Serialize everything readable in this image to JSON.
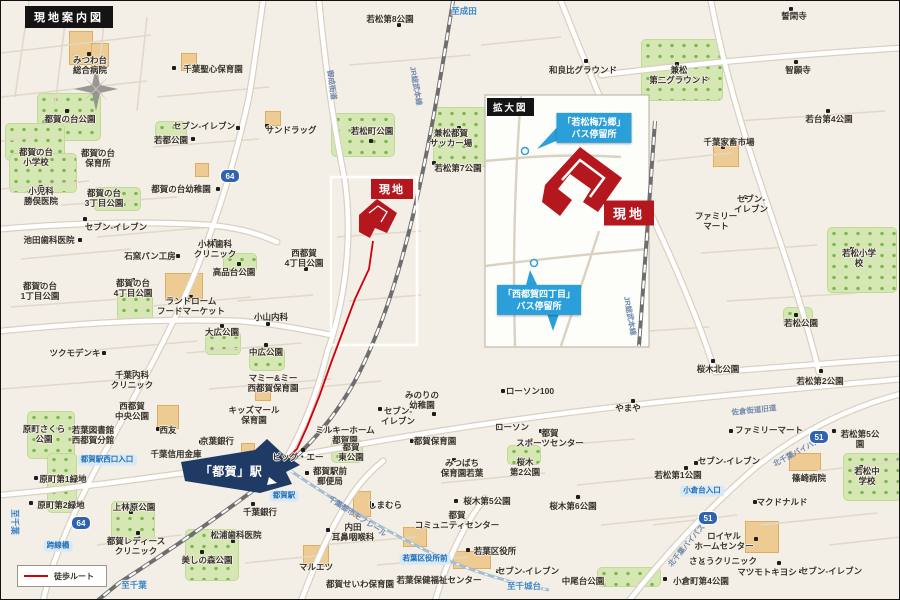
{
  "map": {
    "title_badge": "現地案内図",
    "inset_badge": "拡大図",
    "site_label_main": "現地",
    "site_label_inset": "現地",
    "station_label": "「都賀」駅",
    "legend_walk_route": "徒歩ルート",
    "colors": {
      "background": "#f3efe6",
      "site_red": "#b5171e",
      "route_red": "#cf000e",
      "callout_blue": "#2b9fd9",
      "station_navy": "#203a66",
      "park_green": "#d5e7b2",
      "building_tan": "#eecb92",
      "road_white": "#ffffff"
    },
    "callouts": [
      {
        "lines": [
          "「若松梅乃郷」",
          "バス停留所"
        ],
        "x": 593,
        "y": 127
      },
      {
        "lines": [
          "「西都賀四丁目」",
          "バス停留所"
        ],
        "x": 538,
        "y": 299
      }
    ],
    "shields": [
      {
        "n": "64",
        "x": 229,
        "y": 175
      },
      {
        "n": "64",
        "x": 80,
        "y": 522
      },
      {
        "n": "51",
        "x": 818,
        "y": 436
      },
      {
        "n": "51",
        "x": 707,
        "y": 517
      }
    ],
    "labels": [
      {
        "t": "みつわ台\n総合病院",
        "x": 89,
        "y": 64
      },
      {
        "t": "千葉聖心保育園",
        "x": 212,
        "y": 68
      },
      {
        "t": "都賀の台公園",
        "x": 69,
        "y": 118
      },
      {
        "t": "セブン-イレブン",
        "x": 203,
        "y": 125
      },
      {
        "t": "サンドラッグ",
        "x": 290,
        "y": 129
      },
      {
        "t": "若都公園",
        "x": 170,
        "y": 139
      },
      {
        "t": "都賀の台\n小学校",
        "x": 35,
        "y": 156
      },
      {
        "t": "都賀の台\n保育所",
        "x": 97,
        "y": 157
      },
      {
        "t": "小児科\n勝俣医院",
        "x": 40,
        "y": 195
      },
      {
        "t": "都賀の台幼稚園",
        "x": 180,
        "y": 188
      },
      {
        "t": "都賀の台\n3丁目公園",
        "x": 103,
        "y": 197
      },
      {
        "t": "セブン-イレブン",
        "x": 115,
        "y": 226
      },
      {
        "t": "池田歯科医院",
        "x": 48,
        "y": 239
      },
      {
        "t": "石窯パン工房",
        "x": 149,
        "y": 255
      },
      {
        "t": "小林歯科\nクリニック",
        "x": 214,
        "y": 248
      },
      {
        "t": "高品台公園",
        "x": 233,
        "y": 271
      },
      {
        "t": "都賀の台\n1丁目公園",
        "x": 39,
        "y": 290
      },
      {
        "t": "都賀の台\n4丁目公園",
        "x": 132,
        "y": 287
      },
      {
        "t": "ランドローム\nフードマーケット",
        "x": 190,
        "y": 305
      },
      {
        "t": "小山内科",
        "x": 270,
        "y": 316
      },
      {
        "t": "大広公園",
        "x": 221,
        "y": 331
      },
      {
        "t": "中広公園",
        "x": 265,
        "y": 351
      },
      {
        "t": "ツクモデンキ",
        "x": 74,
        "y": 352
      },
      {
        "t": "千葉内科\nクリニック",
        "x": 131,
        "y": 379
      },
      {
        "t": "西都賀\n4丁目公園",
        "x": 303,
        "y": 257
      },
      {
        "t": "若松第8公園",
        "x": 389,
        "y": 18
      },
      {
        "t": "若松町公園",
        "x": 371,
        "y": 130
      },
      {
        "t": "兼松都賀\nサッカー場",
        "x": 450,
        "y": 137
      },
      {
        "t": "若松第7公園",
        "x": 457,
        "y": 167
      },
      {
        "t": "和良比グラウンド",
        "x": 582,
        "y": 69
      },
      {
        "t": "兼松\n第二グラウンド",
        "x": 678,
        "y": 74
      },
      {
        "t": "智願寺",
        "x": 797,
        "y": 69
      },
      {
        "t": "誓閑寺",
        "x": 793,
        "y": 15
      },
      {
        "t": "若台第4公園",
        "x": 828,
        "y": 118
      },
      {
        "t": "千葉家畜市場",
        "x": 728,
        "y": 141
      },
      {
        "t": "セブン-\nイレブン",
        "x": 750,
        "y": 203
      },
      {
        "t": "ファミリー\nマート",
        "x": 715,
        "y": 220
      },
      {
        "t": "若松小学校",
        "x": 858,
        "y": 257
      },
      {
        "t": "若松公園",
        "x": 800,
        "y": 322
      },
      {
        "t": "若松第2公園",
        "x": 819,
        "y": 380
      },
      {
        "t": "桜木北公園",
        "x": 717,
        "y": 368
      },
      {
        "t": "やまや",
        "x": 627,
        "y": 407
      },
      {
        "t": "ローソン100",
        "x": 529,
        "y": 390
      },
      {
        "t": "ファミリーマート",
        "x": 768,
        "y": 429
      },
      {
        "t": "若松第5公園",
        "x": 859,
        "y": 438
      },
      {
        "t": "セブン-イレブン",
        "x": 728,
        "y": 460
      },
      {
        "t": "若松第1公園",
        "x": 677,
        "y": 474
      },
      {
        "t": "マクドナルド",
        "x": 781,
        "y": 501
      },
      {
        "t": "篠崎病院",
        "x": 808,
        "y": 477
      },
      {
        "t": "若松中学校",
        "x": 866,
        "y": 475
      },
      {
        "t": "ロイヤル\nホームセンター",
        "x": 723,
        "y": 540
      },
      {
        "t": "さとうクリニック",
        "x": 722,
        "y": 560
      },
      {
        "t": "マツモトキヨシ",
        "x": 766,
        "y": 571
      },
      {
        "t": "セブン-イレブン",
        "x": 830,
        "y": 570
      },
      {
        "t": "小倉町第4公園",
        "x": 700,
        "y": 580
      },
      {
        "t": "中尾台公園",
        "x": 582,
        "y": 580
      },
      {
        "t": "みのりの\n幼稚園",
        "x": 421,
        "y": 399
      },
      {
        "t": "セブン-\nイレブン",
        "x": 397,
        "y": 415
      },
      {
        "t": "ローソン",
        "x": 511,
        "y": 426
      },
      {
        "t": "都賀\nスポーツセンター",
        "x": 549,
        "y": 437
      },
      {
        "t": "都賀保育園",
        "x": 434,
        "y": 440
      },
      {
        "t": "ミルキーホーム\n都賀園",
        "x": 344,
        "y": 434
      },
      {
        "t": "都賀\n東公園",
        "x": 350,
        "y": 451
      },
      {
        "t": "みつばち\n保育園若葉",
        "x": 461,
        "y": 467
      },
      {
        "t": "桜木\n第2公園",
        "x": 524,
        "y": 466
      },
      {
        "t": "桜木第5公園",
        "x": 486,
        "y": 500
      },
      {
        "t": "桜木第6公園",
        "x": 572,
        "y": 505
      },
      {
        "t": "都賀\nコミュニティセンター",
        "x": 456,
        "y": 519
      },
      {
        "t": "若葉区役所",
        "x": 494,
        "y": 550
      },
      {
        "t": "若葉保健福祉センター",
        "x": 438,
        "y": 579
      },
      {
        "t": "セブン-イレブン",
        "x": 527,
        "y": 570
      },
      {
        "t": "マルエツ",
        "x": 315,
        "y": 566
      },
      {
        "t": "都賀せいわ保育園",
        "x": 359,
        "y": 583
      },
      {
        "t": "内田\n耳鼻咽喉科",
        "x": 352,
        "y": 531
      },
      {
        "t": "しまむら",
        "x": 384,
        "y": 504
      },
      {
        "t": "都賀駅前\n郵便局",
        "x": 329,
        "y": 475
      },
      {
        "t": "ビッグ・エー",
        "x": 297,
        "y": 456
      },
      {
        "t": "千葉銀行",
        "x": 259,
        "y": 511
      },
      {
        "t": "松浦歯科医院",
        "x": 235,
        "y": 534
      },
      {
        "t": "美しの森公園",
        "x": 206,
        "y": 559
      },
      {
        "t": "都賀レディース\nクリニック",
        "x": 135,
        "y": 545
      },
      {
        "t": "上林原公園",
        "x": 133,
        "y": 506
      },
      {
        "t": "原町第1緑地",
        "x": 62,
        "y": 478
      },
      {
        "t": "原町第2緑地",
        "x": 60,
        "y": 504
      },
      {
        "t": "原町さくら\n公園",
        "x": 43,
        "y": 433
      },
      {
        "t": "若葉図書館\n西都賀分館",
        "x": 92,
        "y": 434
      },
      {
        "t": "西都賀\n中央公園",
        "x": 131,
        "y": 410
      },
      {
        "t": "西友",
        "x": 167,
        "y": 429
      },
      {
        "t": "京葉銀行",
        "x": 216,
        "y": 440
      },
      {
        "t": "千葉信用金庫",
        "x": 175,
        "y": 453
      },
      {
        "t": "キッズマール\n保育園",
        "x": 253,
        "y": 414
      },
      {
        "t": "マミー&ミー\n西都賀保育園",
        "x": 272,
        "y": 382
      },
      {
        "t": "至成田",
        "x": 463,
        "y": 10,
        "c": "blue"
      },
      {
        "t": "至千葉",
        "x": 133,
        "y": 584,
        "c": "blue"
      },
      {
        "t": "至千城台",
        "x": 523,
        "y": 585,
        "c": "blue"
      },
      {
        "t": "至千葉",
        "x": 14,
        "y": 521,
        "c": "blue",
        "r": 90
      },
      {
        "t": "御成街道",
        "x": 330,
        "y": 84,
        "c": "road",
        "r": 82
      },
      {
        "t": "JR総武本線",
        "x": 414,
        "y": 85,
        "c": "road",
        "r": 80
      },
      {
        "t": "JR総武本線",
        "x": 628,
        "y": 315,
        "c": "road",
        "r": 80
      },
      {
        "t": "千葉都市モノレール",
        "x": 356,
        "y": 516,
        "c": "road",
        "r": 33
      },
      {
        "t": "北千葉バイパス",
        "x": 796,
        "y": 452,
        "c": "road",
        "r": -28
      },
      {
        "t": "北千葉バイパス",
        "x": 686,
        "y": 545,
        "c": "road",
        "r": -50
      },
      {
        "t": "佐倉街道旧道",
        "x": 753,
        "y": 410,
        "c": "road",
        "r": -6
      },
      {
        "t": "都賀駅西口入口",
        "x": 106,
        "y": 459,
        "c": "pill"
      },
      {
        "t": "都賀駅",
        "x": 283,
        "y": 495,
        "c": "pill"
      },
      {
        "t": "跨線橋",
        "x": 57,
        "y": 545,
        "c": "pill"
      },
      {
        "t": "小倉台入口",
        "x": 701,
        "y": 490,
        "c": "pill"
      },
      {
        "t": "若葉区役所前",
        "x": 424,
        "y": 558,
        "c": "pill"
      }
    ],
    "dots": [
      [
        88,
        53
      ],
      [
        173,
        67
      ],
      [
        66,
        110
      ],
      [
        237,
        127
      ],
      [
        266,
        125
      ],
      [
        192,
        138
      ],
      [
        35,
        150
      ],
      [
        97,
        150
      ],
      [
        40,
        186
      ],
      [
        217,
        188
      ],
      [
        98,
        190
      ],
      [
        84,
        218
      ],
      [
        79,
        239
      ],
      [
        177,
        255
      ],
      [
        214,
        240
      ],
      [
        238,
        263
      ],
      [
        39,
        283
      ],
      [
        132,
        279
      ],
      [
        190,
        296
      ],
      [
        267,
        323
      ],
      [
        221,
        325
      ],
      [
        265,
        344
      ],
      [
        103,
        352
      ],
      [
        133,
        371
      ],
      [
        305,
        268
      ],
      [
        398,
        24
      ],
      [
        370,
        140
      ],
      [
        458,
        127
      ],
      [
        433,
        162
      ],
      [
        585,
        60
      ],
      [
        676,
        63
      ],
      [
        795,
        61
      ],
      [
        790,
        8
      ],
      [
        827,
        110
      ],
      [
        722,
        146
      ],
      [
        745,
        196
      ],
      [
        700,
        213
      ],
      [
        851,
        248
      ],
      [
        795,
        314
      ],
      [
        820,
        370
      ],
      [
        712,
        360
      ],
      [
        632,
        400
      ],
      [
        502,
        390
      ],
      [
        730,
        430
      ],
      [
        833,
        430
      ],
      [
        695,
        462
      ],
      [
        685,
        467
      ],
      [
        754,
        501
      ],
      [
        795,
        475
      ],
      [
        860,
        466
      ],
      [
        755,
        538
      ],
      [
        701,
        560
      ],
      [
        778,
        562
      ],
      [
        800,
        570
      ],
      [
        664,
        578
      ],
      [
        566,
        578
      ],
      [
        497,
        570
      ],
      [
        467,
        549
      ],
      [
        455,
        500
      ],
      [
        577,
        496
      ],
      [
        453,
        459
      ],
      [
        540,
        430
      ],
      [
        496,
        425
      ],
      [
        411,
        440
      ],
      [
        433,
        413
      ],
      [
        379,
        408
      ],
      [
        344,
        443
      ],
      [
        306,
        472
      ],
      [
        302,
        449
      ],
      [
        371,
        504
      ],
      [
        327,
        529
      ],
      [
        330,
        583
      ],
      [
        252,
        503
      ],
      [
        232,
        540
      ],
      [
        201,
        551
      ],
      [
        137,
        532
      ],
      [
        130,
        511
      ],
      [
        35,
        477
      ],
      [
        30,
        502
      ],
      [
        35,
        426
      ],
      [
        157,
        428
      ],
      [
        200,
        441
      ],
      [
        160,
        452
      ]
    ],
    "parks": [
      [
        36,
        92,
        62,
        46
      ],
      [
        4,
        122,
        58,
        36
      ],
      [
        8,
        152,
        66,
        38
      ],
      [
        92,
        186,
        46,
        22
      ],
      [
        116,
        292,
        34,
        26
      ],
      [
        204,
        330,
        34,
        22
      ],
      [
        248,
        346,
        34,
        22
      ],
      [
        222,
        252,
        32,
        18
      ],
      [
        154,
        120,
        30,
        20
      ],
      [
        330,
        112,
        62,
        42
      ],
      [
        432,
        106,
        88,
        58
      ],
      [
        640,
        38,
        80,
        60
      ],
      [
        826,
        226,
        68,
        64
      ],
      [
        842,
        452,
        56,
        46
      ],
      [
        184,
        528,
        52,
        50
      ],
      [
        110,
        500,
        42,
        38
      ],
      [
        26,
        410,
        46,
        46
      ],
      [
        46,
        452,
        28,
        58
      ],
      [
        330,
        438,
        30,
        22
      ],
      [
        506,
        444,
        32,
        18
      ],
      [
        596,
        566,
        62,
        18
      ],
      [
        782,
        306,
        28,
        18
      ]
    ],
    "buildings": [
      [
        68,
        30,
        22,
        32
      ],
      [
        90,
        42,
        16,
        22
      ],
      [
        180,
        52,
        14,
        16
      ],
      [
        264,
        110,
        14,
        13
      ],
      [
        712,
        144,
        24,
        20
      ],
      [
        156,
        404,
        20,
        22
      ],
      [
        302,
        544,
        24,
        20
      ],
      [
        744,
        520,
        32,
        30
      ],
      [
        352,
        490,
        16,
        24
      ],
      [
        164,
        272,
        36,
        26
      ],
      [
        788,
        452,
        30,
        16
      ],
      [
        452,
        550,
        36,
        16
      ],
      [
        240,
        442,
        12,
        12
      ],
      [
        402,
        526,
        22,
        18
      ],
      [
        254,
        386,
        14,
        12
      ],
      [
        194,
        162,
        12,
        12
      ]
    ]
  }
}
